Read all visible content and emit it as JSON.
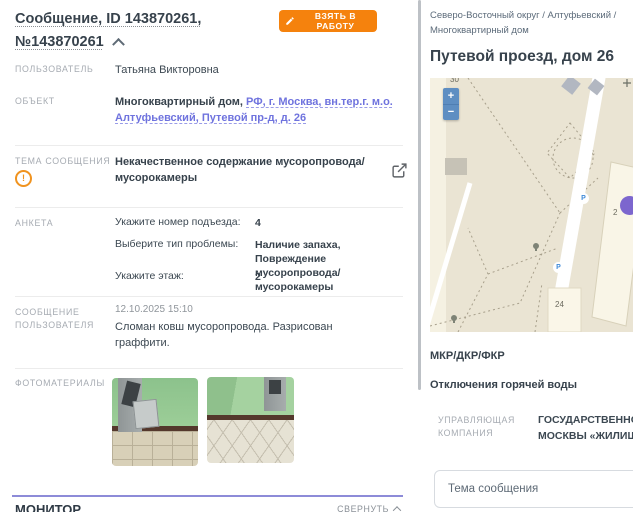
{
  "message_panel": {
    "title": "Сообщение, ID 143870261, №143870261",
    "take_to_work_button": "ВЗЯТЬ В РАБОТУ",
    "user": {
      "label": "ПОЛЬЗОВАТЕЛЬ",
      "value": "Татьяна Викторовна"
    },
    "object": {
      "label": "ОБЪЕКТ",
      "type": "Многоквартирный дом,",
      "address_link": "РФ, г. Москва, вн.тер.г. м.о. Алтуфьевский, Путевой пр-д, д. 26"
    },
    "topic": {
      "label": "ТЕМА СООБЩЕНИЯ",
      "warning_glyph": "!",
      "value": "Некачественное содержание мусоропровода/мусорокамеры"
    },
    "anketa": {
      "label": "АНКЕТА",
      "rows": [
        {
          "q": "Укажите номер подъезда:",
          "a": "4"
        },
        {
          "q": "Выберите тип проблемы:",
          "a": "Наличие запаха, Повреждение мусоропровода/мусорокамеры"
        },
        {
          "q": "Укажите этаж:",
          "a": "2"
        }
      ]
    },
    "user_message": {
      "label": "СООБЩЕНИЕ ПОЛЬЗОВАТЕЛЯ",
      "datetime": "12.10.2025 15:10",
      "text": "Сломан ковш мусоропровода. Разрисован граффити."
    },
    "photos": {
      "label": "ФОТОМАТЕРИАЛЫ"
    },
    "monitor": {
      "title": "МОНИТОР",
      "collapse_label": "СВЕРНУТЬ"
    }
  },
  "object_panel": {
    "breadcrumb": "Северо-Восточный округ / Алтуфьевский / Многоквартирный дом",
    "title": "Путевой проезд, дом 26",
    "map": {
      "zoom_in": "+",
      "zoom_out": "−",
      "parking_glyph": "P",
      "labels": {
        "b24": "24",
        "b30": "30",
        "b2": "2"
      }
    },
    "sections": {
      "mkr": "МКР/ДКР/ФКР",
      "hot_water": "Отключения горячей воды"
    },
    "management_company": {
      "label": "УПРАВЛЯЮЩАЯ КОМПАНИЯ",
      "line1": "ГОСУДАРСТВЕННОЕ БЮДЖЕТНОЕ",
      "line2": "МОСКВЫ «ЖИЛИЩНИК»"
    },
    "topic_input_placeholder": "Тема сообщения"
  },
  "colors": {
    "accent_orange": "#F5820D",
    "link_purple": "#6F73DE",
    "divider_purple": "#8D8BD8",
    "map_marker_purple": "#7C66CE",
    "parking_blue": "#3E8AD8",
    "map_background": "#EAE4D3"
  }
}
